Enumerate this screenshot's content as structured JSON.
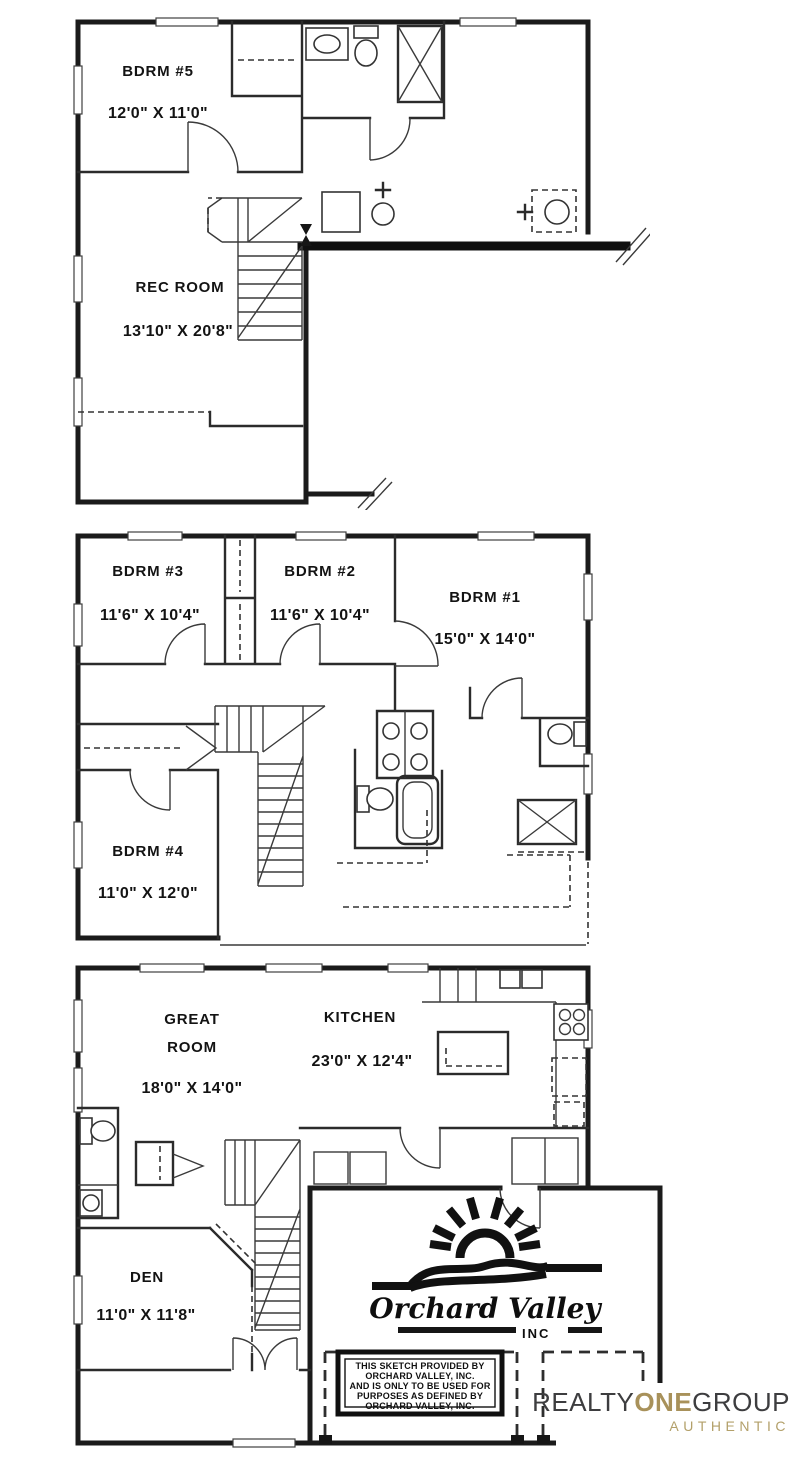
{
  "page": {
    "background": "#ffffff",
    "ink": "#1b1b1b"
  },
  "floorplans": {
    "basement": {
      "bdrm5_label": "BDRM #5",
      "bdrm5_dims": "12'0\" X 11'0\"",
      "recroom_label": "REC ROOM",
      "recroom_dims": "13'10\" X 20'8\""
    },
    "upper": {
      "bdrm3_label": "BDRM #3",
      "bdrm3_dims": "11'6\" X 10'4\"",
      "bdrm2_label": "BDRM #2",
      "bdrm2_dims": "11'6\" X 10'4\"",
      "bdrm1_label": "BDRM #1",
      "bdrm1_dims": "15'0\" X 14'0\"",
      "bdrm4_label": "BDRM #4",
      "bdrm4_dims": "11'0\" X 12'0\""
    },
    "main": {
      "greatroom_label_line1": "GREAT",
      "greatroom_label_line2": "ROOM",
      "greatroom_dims": "18'0\" X 14'0\"",
      "kitchen_label": "KITCHEN",
      "kitchen_dims": "23'0\" X 12'4\"",
      "den_label": "DEN",
      "den_dims": "11'0\" X 11'8\""
    }
  },
  "builder": {
    "logo_name": "Orchard Valley",
    "logo_suffix": "INC",
    "disclaimer_line1": "THIS SKETCH PROVIDED BY",
    "disclaimer_line2": "ORCHARD VALLEY, INC.",
    "disclaimer_line3": "AND IS ONLY TO BE USED FOR",
    "disclaimer_line4": "PURPOSES AS DEFINED BY",
    "disclaimer_line5": "ORCHARD VALLEY, INC."
  },
  "brokerage": {
    "word1": "REALTY",
    "word2": "ONE",
    "word3": "GROUP",
    "tagline": "AUTHENTIC",
    "gold": "#a8915a",
    "charcoal": "#3d3d3f"
  }
}
